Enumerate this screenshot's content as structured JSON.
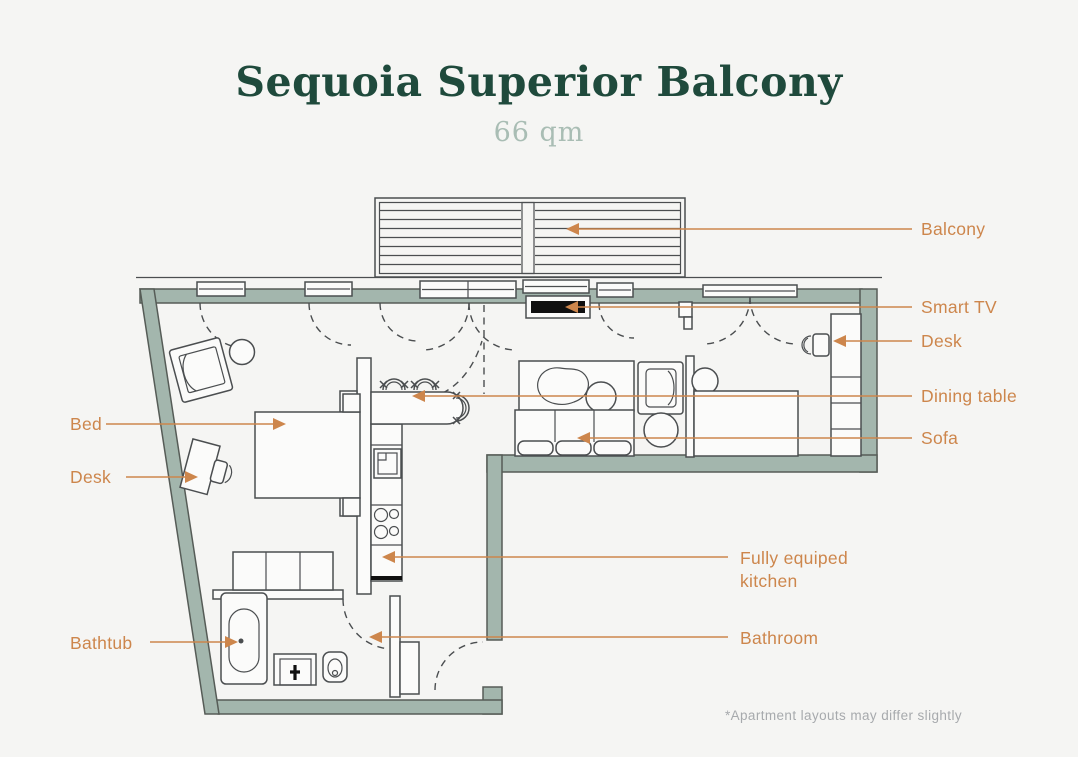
{
  "header": {
    "title": "Sequoia Superior Balcony",
    "subtitle": "66 qm"
  },
  "plan_labels": {
    "bed": "Bed",
    "desk_bedroom": "Desk",
    "bathtub": "Bathtub",
    "balcony": "Balcony",
    "smart_tv": "Smart TV",
    "desk_living": "Desk",
    "dining_table": "Dining table",
    "sofa": "Sofa",
    "kitchen": "Fully equiped kitchen",
    "bathroom": "Bathroom"
  },
  "footnote": "*Apartment layouts may differ slightly",
  "colors": {
    "accent": "#cd864c",
    "wall_fill": "#a3b6ad",
    "wall_stroke": "#565c57",
    "line": "#4b4e50",
    "title": "#1f4a3c",
    "subtitle": "#a9bdb4",
    "footnote": "#a7aaad",
    "background": "#f5f5f3",
    "furniture_fill": "#fbfbfa",
    "tv": "#101010"
  }
}
